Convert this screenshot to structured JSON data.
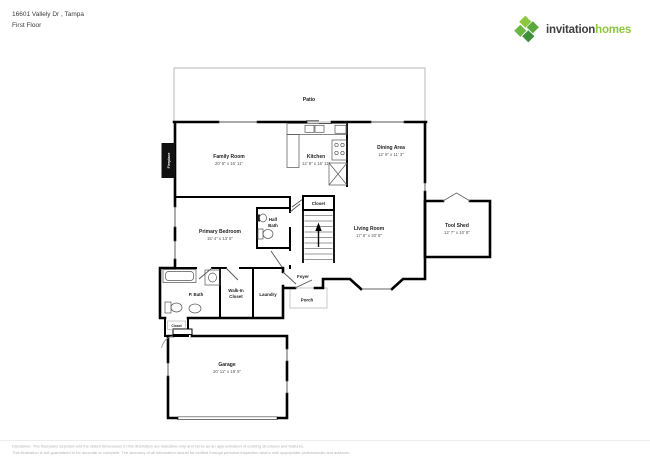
{
  "header": {
    "address": "16601 Vallely Dr , Tampa",
    "floor": "First Floor"
  },
  "logo": {
    "brand_primary": "invitation",
    "brand_secondary": "homes"
  },
  "colors": {
    "wall": "#000000",
    "brand_green": "#8dc63f",
    "brand_dark": "#3f3f41",
    "room_label": "#222222",
    "dims_label": "#555555",
    "disclaimer_text": "#b3b3b3"
  },
  "rooms": {
    "patio": {
      "name": "Patio"
    },
    "family_room": {
      "name": "Family Room",
      "dims": "20' 6\" x 16' 11\""
    },
    "kitchen": {
      "name": "Kitchen",
      "dims": "12' 9\" x 16' 11\""
    },
    "dining_area": {
      "name": "Dining Area",
      "dims": "12' 6\" x 11' 3\""
    },
    "primary_bedroom": {
      "name": "Primary Bedroom",
      "dims": "15' 4\" x 13' 5\""
    },
    "half_bath": {
      "line1": "Half",
      "line2": "Bath"
    },
    "closet_upper": {
      "name": "Closet"
    },
    "living_room": {
      "name": "Living Room",
      "dims": "17' 5\" x 20' 8\""
    },
    "tool_shed": {
      "name": "Tool Shed",
      "dims": "12' 7\" x 10' 8\""
    },
    "p_bath": {
      "name": "P. Bath"
    },
    "walk_in_closet": {
      "line1": "Walk-In",
      "line2": "Closet"
    },
    "laundry": {
      "name": "Laundry"
    },
    "foyer": {
      "name": "Foyer"
    },
    "porch": {
      "name": "Porch"
    },
    "closet_lower": {
      "name": "Closet"
    },
    "garage": {
      "name": "Garage",
      "dims": "20' 11\" x 19' 5\""
    },
    "fireplace": {
      "name": "Fireplace"
    }
  },
  "disclaimer": {
    "line1": "Disclaimer: The floorplans depicted and the stated dimensions in this illustration are indicative only and serve as an approximation of existing structures and features.",
    "line2": "This illustration is not guaranteed to be accurate or complete. The accuracy of all information should be verified through personal inspection and/or with appropriate professionals and advisors."
  }
}
